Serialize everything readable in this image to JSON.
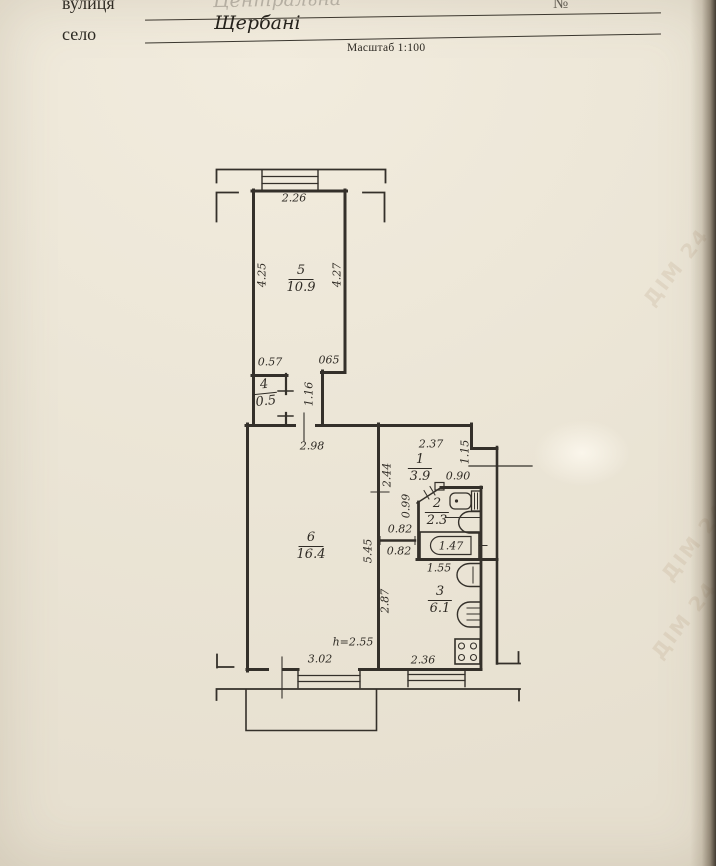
{
  "header": {
    "street_label": "вулиця",
    "street_value_faint": "Центральна",
    "number_sign": "№",
    "village_label": "село",
    "village_value": "Щербані",
    "scale_note": "Масштаб 1:100"
  },
  "watermark_text": "ДІМ 24",
  "rooms": [
    {
      "number": "5",
      "area": "10.9"
    },
    {
      "number": "4",
      "area": "0.5"
    },
    {
      "number": "6",
      "area": "16.4"
    },
    {
      "number": "1",
      "area": "3.9"
    },
    {
      "number": "2",
      "area": "2.3"
    },
    {
      "number": "3",
      "area": "6.1"
    }
  ],
  "dims": {
    "room5_top": "2.26",
    "room5_left": "4.25",
    "room5_right": "4.27",
    "room5_bottom_left": "0.57",
    "room5_bottom_right": "065",
    "corridor_width": "1.16",
    "room6_top": "2.98",
    "hall_top": "2.37",
    "entry_depth": "1.15",
    "entry_width": "0.90",
    "hall_height": "2.44",
    "hall_width_upper": "0.99",
    "hall_width_mid": "0.82",
    "hall_width_lower": "0.82",
    "bathtub_length": "1.47",
    "kitchen_top": "1.55",
    "kitchen_left": "2.87",
    "room6_right": "5.45",
    "ceiling_height": "h=2.55",
    "room6_bottom": "3.02",
    "kitchen_bottom": "2.36"
  },
  "colors": {
    "paper": "#ece6d7",
    "ink": "#34302a"
  }
}
